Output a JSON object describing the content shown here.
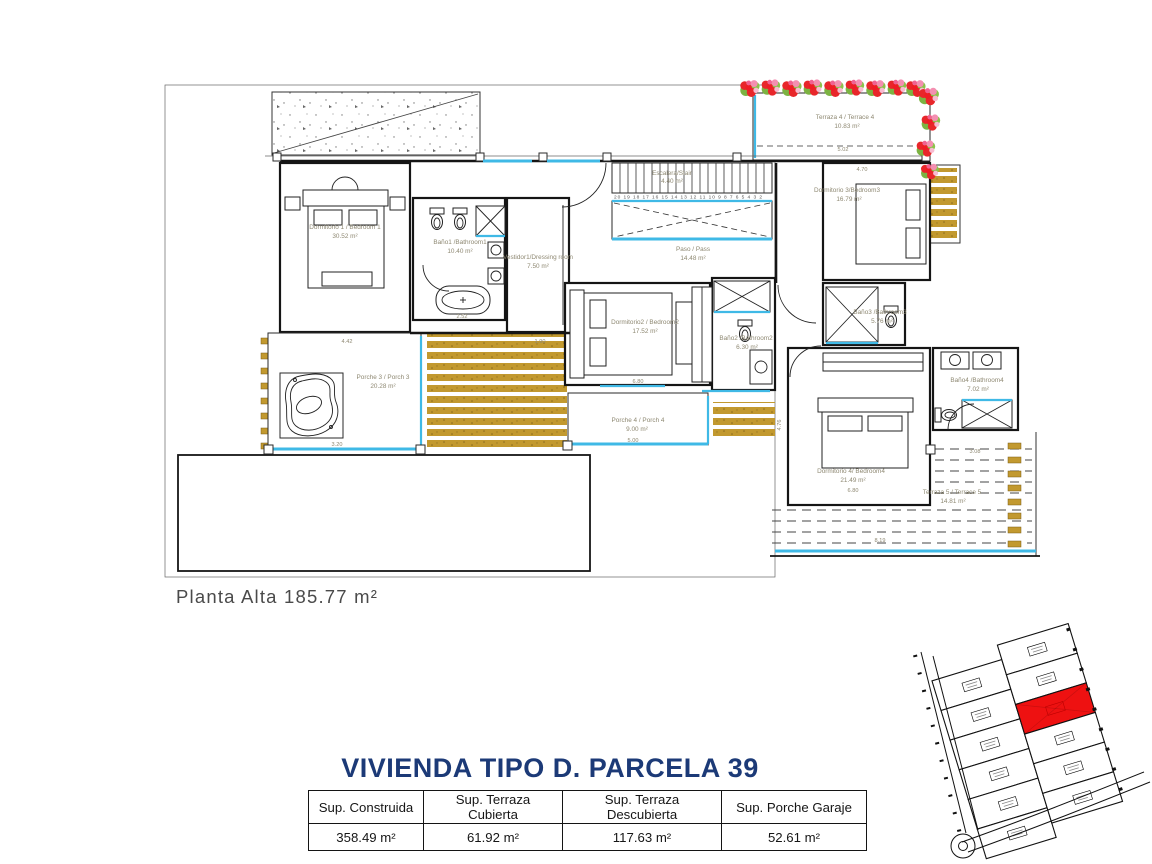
{
  "plan": {
    "floor_label": "Planta Alta 185.77 m²",
    "rooms": [
      {
        "name": "Dormitorio 1 / Bedroom 1",
        "area": "30.52 m²"
      },
      {
        "name": "Baño1 /Bathroom1",
        "area": "10.40 m²"
      },
      {
        "name": "Vestidor1/Dressing room",
        "area": "7.50 m²"
      },
      {
        "name": "Escalera/Stair",
        "area": "4.40 m²"
      },
      {
        "name": "Paso / Pass",
        "area": "14.48 m²"
      },
      {
        "name": "Dormitorio 3/Bedroom3",
        "area": "16.79 m²"
      },
      {
        "name": "Terraza 4 / Terrace 4",
        "area": "10.83 m²"
      },
      {
        "name": "Dormitorio2 / Bedroom2",
        "area": "17.52 m²"
      },
      {
        "name": "Baño2 /Bathroom2",
        "area": "6.30 m²"
      },
      {
        "name": "Baño3 /Bathroom3",
        "area": "5.76 m²"
      },
      {
        "name": "Baño4 /Bathroom4",
        "area": "7.02 m²"
      },
      {
        "name": "Dormitorio 4/ Bedroom4",
        "area": "21.49 m²"
      },
      {
        "name": "Porche 3 / Porch 3",
        "area": "20.28 m²"
      },
      {
        "name": "Porche 4 / Porch 4",
        "area": "9.00 m²"
      },
      {
        "name": "Terraza 5 / Terrace 5",
        "area": "14.81 m²"
      }
    ],
    "stair_numbers": "20 19 18 17 16 15 14 13 12 11 10 9 8 7 6 5 4 3 2",
    "dims": [
      "4.42",
      "1.90",
      "5.02",
      "4.70",
      "6.80",
      "5.00",
      "3.20",
      "3.08",
      "6.80",
      "8.19",
      "4.76",
      "2.52"
    ]
  },
  "summary": {
    "title": "VIVIENDA TIPO D. PARCELA 39",
    "table": {
      "headers": [
        "Sup. Construida",
        "Sup. Terraza Cubierta",
        "Sup. Terraza Descubierta",
        "Sup. Porche Garaje"
      ],
      "values": [
        "358.49 m²",
        "61.92 m²",
        "117.63 m²",
        "52.61 m²"
      ]
    }
  },
  "site_map": {
    "highlighted_parcel_color": "#ee1111"
  },
  "colors": {
    "accent_blue": "#3fb9e6",
    "deck_gold": "#c2992f",
    "flower_red": "#e8262a",
    "leaf_green": "#7cb342",
    "title_navy": "#1c3a77",
    "highlight_red": "#ee1111"
  }
}
